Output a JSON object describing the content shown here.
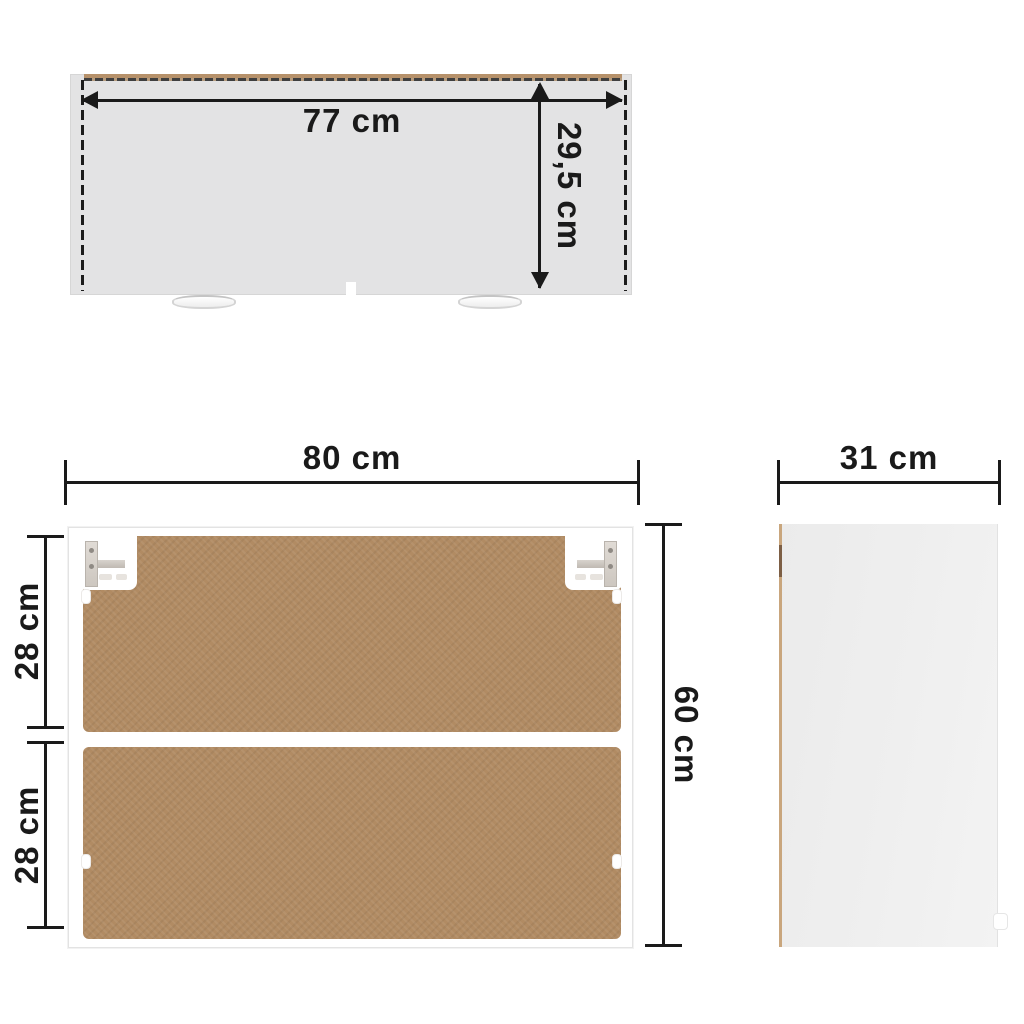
{
  "labels": {
    "top_width": "77 cm",
    "top_depth": "29,5 cm",
    "front_width": "80 cm",
    "front_height": "60 cm",
    "front_upper_section": "28 cm",
    "front_lower_section": "28 cm",
    "side_depth": "31 cm"
  },
  "colors": {
    "dimension_ink": "#1a1a1a",
    "top_panel_gray": "#e3e3e4",
    "edge_tan": "#b6916a",
    "back_board_brown": "#b18b63",
    "cabinet_white": "#ffffff",
    "side_panel_gray": "#eeeeee"
  }
}
